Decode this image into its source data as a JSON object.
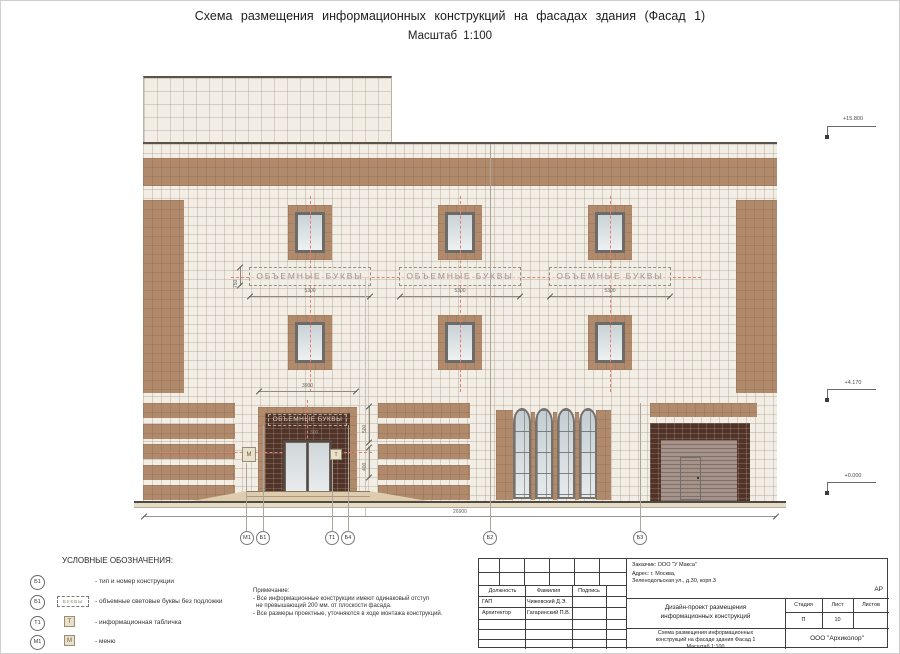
{
  "page": {
    "title": "Схема  размещения  информационных  конструкций  на  фасадах  здания  (Фасад 1)",
    "scale": "Масштаб  1:100"
  },
  "drawing": {
    "sign_label": "ОБЪЕМНЫЕ  БУКВЫ",
    "menu_letter": "М",
    "plaque_letter": "Т",
    "dims": {
      "sign_width": "5300",
      "sign_height": "750",
      "entrance_width": "3900",
      "offset": "300",
      "h_upper": "500",
      "h_lower": "400",
      "total": "26900"
    },
    "elevations": [
      "+15.800",
      "+4.170",
      "+0.000"
    ],
    "markers": [
      "М1",
      "Б1",
      "Т1",
      "Б4",
      "Б2",
      "Б3"
    ]
  },
  "legend": {
    "title": "УСЛОВНЫЕ ОБОЗНАЧЕНИЯ:",
    "items": [
      {
        "badge": "Б1",
        "text": "- тип и номер конструкции"
      },
      {
        "badge": "Б1",
        "symbol": "БУКВЫ",
        "text": "- объемные световые буквы без подложки"
      },
      {
        "badge": "Т1",
        "symbol": "Т",
        "text": "- информационная табличка"
      },
      {
        "badge": "М1",
        "symbol": "М",
        "text": "- меню"
      }
    ]
  },
  "notes": {
    "title": "Примечание:",
    "line1": "- Все информационные конструкции имеют одинаковый отступ",
    "line2": "не превышающий 200 мм. от плоскости фасада.",
    "line3": "- Все размеры проектные, уточняются в ходе монтажа конструкций."
  },
  "titleblock": {
    "customer": "Заказчик:  ООО  \"У Макса\"",
    "address1": "Адрес:  г. Москва,",
    "address2": "Зеленодольская  ул.,  д.30,  корп.3",
    "code": "АР",
    "col_role": "Должность",
    "col_name": "Фамилия",
    "col_sign": "Подпись",
    "row1_role": "ГАП",
    "row1_name": "Чижевский Д.Э.",
    "row2_role": "Архитектор",
    "row2_name": "Гагаринский П.В.",
    "project_line1": "Дизайн-проект  размещения",
    "project_line2": "информационных  конструкций",
    "stage_label": "Стадия",
    "sheet_label": "Лист",
    "sheets_label": "Листов",
    "stage": "П",
    "sheet": "10",
    "subtitle_line1": "Схема  размещения  информационных",
    "subtitle_line2": "конструкций  на  фасаде  здания  Фасад 1",
    "subtitle_line3": "Масштаб  1:100",
    "company": "ООО  \"Архиколор\""
  }
}
